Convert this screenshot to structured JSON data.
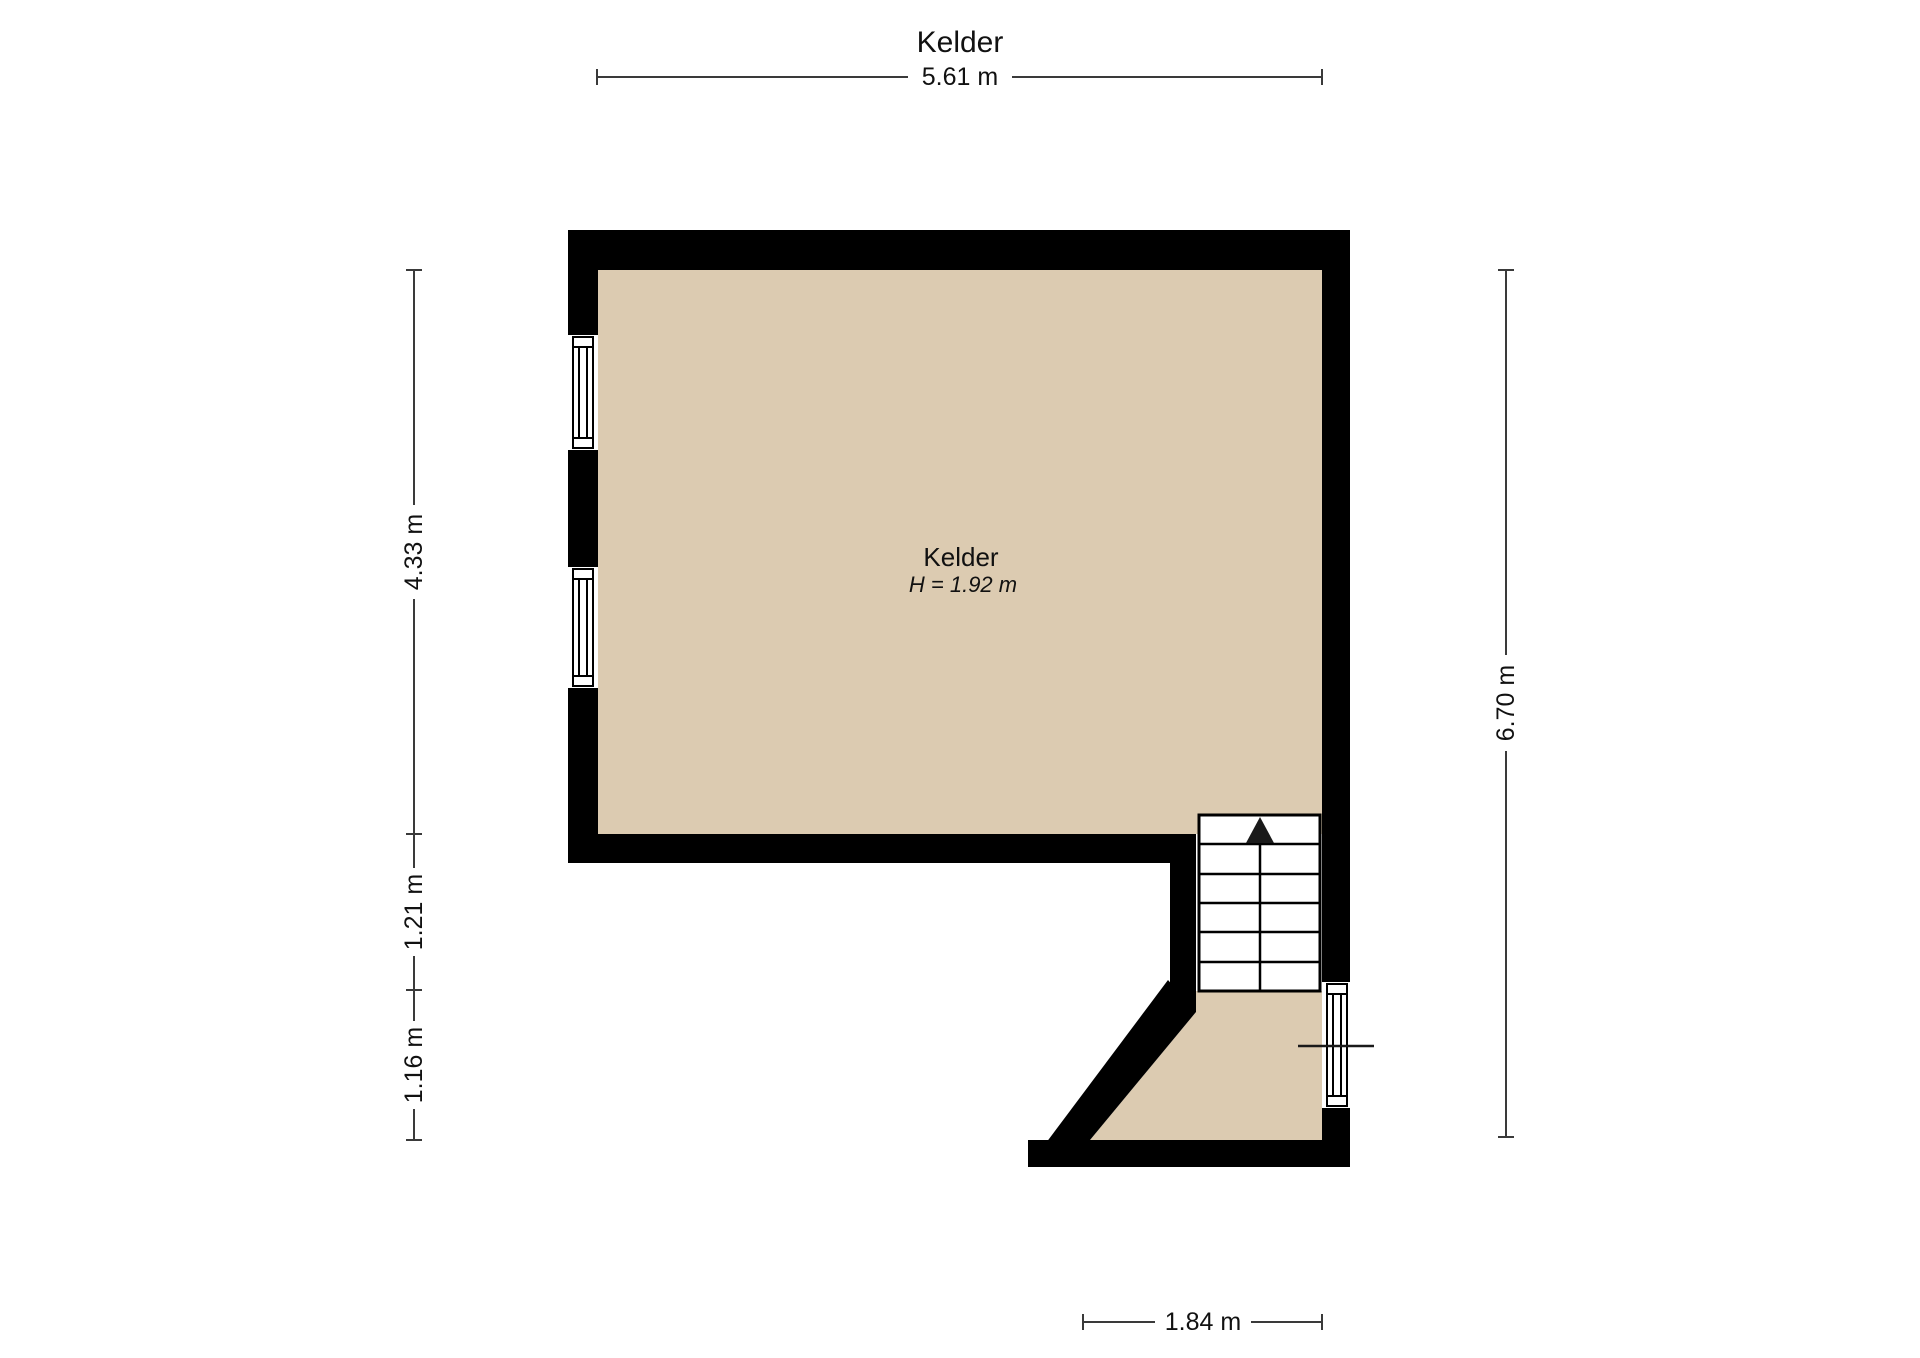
{
  "title": "Kelder",
  "room": {
    "name": "Kelder",
    "ceiling_height": "H = 1.92 m"
  },
  "dimensions": {
    "width_top": "5.61 m",
    "left_segments": [
      "4.33 m",
      "1.21 m",
      "1.16 m"
    ],
    "height_right": "6.70 m",
    "width_bottom": "1.84 m"
  },
  "icons": {
    "stair_direction": "up-arrow-icon"
  },
  "colors": {
    "floor": "#dccbb1",
    "wall": "#000000",
    "window_fill": "#ffffff",
    "dimension_line": "#3a3a3a",
    "text": "#111111"
  }
}
